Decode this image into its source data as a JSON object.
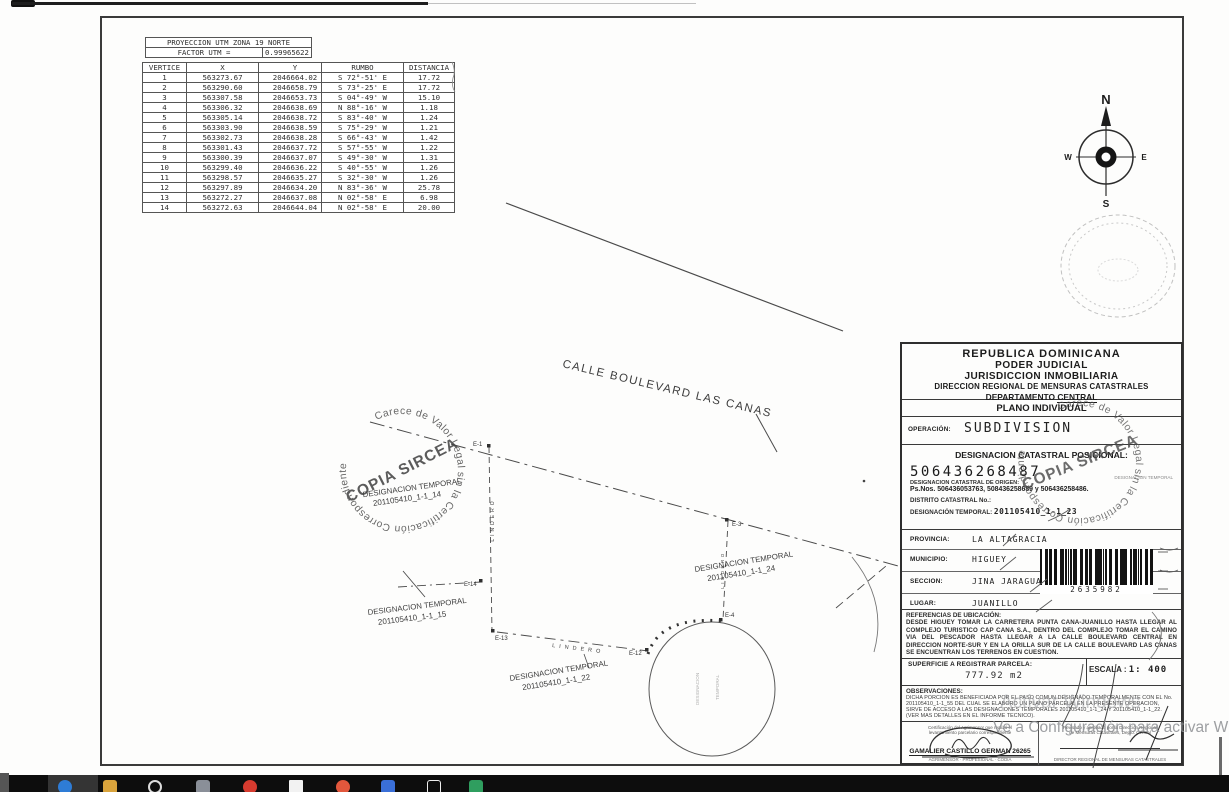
{
  "survey": {
    "projection": {
      "title": "PROYECCION UTM ZONA 19 NORTE",
      "factor_label": "FACTOR UTM =",
      "factor_value": "0.99965622"
    },
    "vertex_headers": [
      "VERTICE",
      "X",
      "Y"
    ],
    "vertices": [
      [
        "1",
        "563273.67",
        "2046664.02"
      ],
      [
        "2",
        "563290.60",
        "2046658.79"
      ],
      [
        "3",
        "563307.58",
        "2046653.73"
      ],
      [
        "4",
        "563306.32",
        "2046638.69"
      ],
      [
        "5",
        "563305.14",
        "2046638.72"
      ],
      [
        "6",
        "563303.90",
        "2046638.59"
      ],
      [
        "7",
        "563302.73",
        "2046638.28"
      ],
      [
        "8",
        "563301.43",
        "2046637.72"
      ],
      [
        "9",
        "563300.39",
        "2046637.07"
      ],
      [
        "10",
        "563299.40",
        "2046636.22"
      ],
      [
        "11",
        "563298.57",
        "2046635.27"
      ],
      [
        "12",
        "563297.89",
        "2046634.20"
      ],
      [
        "13",
        "563272.27",
        "2046637.08"
      ],
      [
        "14",
        "563272.63",
        "2046644.04"
      ]
    ],
    "bearing_headers": [
      "RUMBO",
      "DISTANCIA"
    ],
    "bearings": [
      [
        "S 72°-51' E",
        "17.72"
      ],
      [
        "S 73°-25' E",
        "17.72"
      ],
      [
        "S 04°-49' W",
        "15.10"
      ],
      [
        "N 88°-16' W",
        "1.18"
      ],
      [
        "S 83°-40' W",
        "1.24"
      ],
      [
        "S 75°-29' W",
        "1.21"
      ],
      [
        "S 66°-43' W",
        "1.42"
      ],
      [
        "S 57°-55' W",
        "1.22"
      ],
      [
        "S 49°-30' W",
        "1.31"
      ],
      [
        "S 40°-55' W",
        "1.26"
      ],
      [
        "S 32°-30' W",
        "1.26"
      ],
      [
        "N 83°-36' W",
        "25.78"
      ],
      [
        "N 02°-58' E",
        "6.98"
      ],
      [
        "N 02°-58' E",
        "20.00"
      ]
    ]
  },
  "compass": {
    "north": "N",
    "south": "S",
    "east": "E",
    "west": "W"
  },
  "map": {
    "street": "CALLE BOULEVARD LAS CANAS",
    "lindero": "LINDERO",
    "designation_word": "DESIGNACION  TEMPORAL",
    "parcels": {
      "p14": "201105410_1-1_14",
      "p15": "201105410_1-1_15",
      "p22": "201105410_1-1_22",
      "p24": "201105410_1-1_24"
    },
    "points": {
      "e1": "E-1",
      "e3": "E-3",
      "e4": "E-4",
      "e12": "E-12",
      "e13": "E-13",
      "e14": "E-14"
    },
    "circle_note1": "DESIGNACION",
    "circle_note2": "TEMPORAL"
  },
  "stamp": {
    "ring": "Carece de Valor Legal sin la Certificación Correspondiente",
    "center": "COPIA SIRCEA"
  },
  "title_block": {
    "country": "REPUBLICA DOMINICANA",
    "judicial": "PODER JUDICIAL",
    "jurisdiction": "JURISDICCION INMOBILIARIA",
    "direction": "DIRECCION REGIONAL DE MENSURAS CATASTRALES",
    "department_label": "DEPARTAMENTO",
    "department_value": "CENTRAL",
    "plan_type": "PLANO INDIVIDUAL",
    "operation_label": "OPERACIÓN:",
    "operation_value": "SUBDIVISION",
    "catastral_heading": "DESIGNACION CATASTRAL POSICIONAL:",
    "positional_number": "506436268487",
    "origin_label": "DESIGNACION CATASTRAL DE ORIGEN:",
    "origin_value": "Ps.Nos. 506436053763, 508436258689 y 506436258486.",
    "district_label": "DISTRITO CATASTRAL No.:",
    "temporal_label": "DESIGNACIÓN TEMPORAL:",
    "temporal_value": "201105410_1-1_23",
    "small_right_note": "DESIGNACION TEMPORAL",
    "province_label": "PROVINCIA:",
    "province_value": "LA ALTAGRACIA",
    "municipality_label": "MUNICIPIO:",
    "municipality_value": "HIGUEY",
    "section_label": "SECCION:",
    "section_value": "JINA JARAGUA",
    "place_label": "LUGAR:",
    "place_value": "JUANILLO",
    "barcode_number": "2635982",
    "references_label": "REFERENCIAS DE UBICACIÓN:",
    "references_text": "DESDE HIGUEY TOMAR LA CARRETERA PUNTA CANA-JUANILLO HASTA LLEGAR AL COMPLEJO TURISTICO CAP CANA S.A., DENTRO DEL COMPLEJO TOMAR EL CAMINO VIA DEL PESCADOR HASTA LLEGAR A LA CALLE BOULEVARD CENTRAL EN DIRECCION NORTE-SUR Y EN LA ORILLA SUR DE LA CALLE BOULEVARD LAS CANAS SE ENCUENTRAN LOS TERRENOS EN CUESTION.",
    "area_label": "SUPERFICIE A REGISTRAR PARCELA:",
    "area_value": "777.92 m2",
    "scale_label": "ESCALA :",
    "scale_value": "1: 400",
    "observations_label": "OBSERVACIONES:",
    "observations_lines": [
      "DICHA PORCION ES BENEFICIADA POR EL PASO COMUN DESIGNADO TEMPORALMENTE CON EL No.",
      "201105410_1-1_55 DEL CUAL SE ELABORO UN PLANO PARCELA, EN LA PRESENTE OPERACION,",
      "SIRVE DE ACCESO A LAS DESIGNACIONES TEMPORALES 201105410_1-1_24 Y 201105410_1-1_22.",
      "(VER MAS DETALLES EN EL INFORME TECNICO)."
    ],
    "sig_left_note1": "Certificación del Agrimensor que realizó el",
    "sig_left_note2": "levantamiento parcelario correspondiente",
    "surveyor_name": "GAMALIER CASTILLO GERMAN 26265",
    "sig_left_sub": "AGRIMENSOR  ·  PROFESIONAL  ·  CODIA",
    "sig_right_note1": "Revisado y aprobado por la Dirección Regional",
    "sig_right_note2": "de Mensuras Catastrales, Depto. Central",
    "sig_right_sub": "DIRECTOR REGIONAL DE MENSURAS CATASTRALES"
  },
  "watermark": {
    "line1": "Activar Windows",
    "line2": "Ve a Configuración para activar Wi"
  },
  "taskbar": {
    "icons": [
      "edge-blue",
      "folder-amber",
      "cortana-ring",
      "app-grey",
      "chrome-red",
      "document-white",
      "powerpoint-orange",
      "excel-blue-tile",
      "window-outline",
      "excel-green"
    ]
  }
}
